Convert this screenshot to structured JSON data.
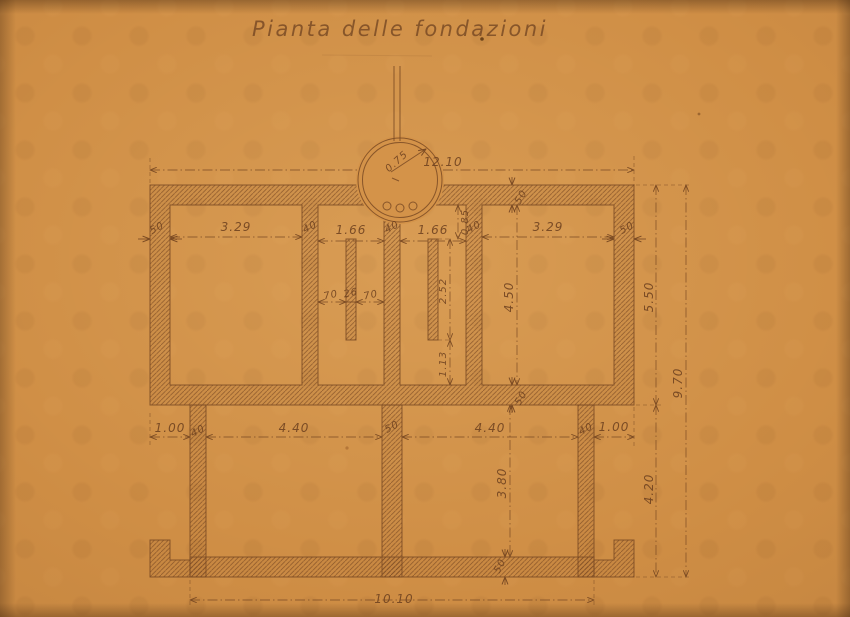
{
  "title": "Pianta delle fondazioni",
  "colors": {
    "paper": "#cf8e45",
    "ink": "#7a4a23"
  },
  "well": {
    "diameter_label": "0.75"
  },
  "labels": {
    "dim_top_width": "12.10",
    "dim_room_tl_width": "3.29",
    "dim_room_tr_width": "3.29",
    "dim_corridor_left_width": "1.66",
    "dim_corridor_right_width": "1.66",
    "dim_wall_left": "50",
    "dim_wall_tl_inner": "40",
    "dim_wall_center": "40",
    "dim_wall_tr_inner": "40",
    "dim_wall_right": "50",
    "dim_top_wall_thickness": "50",
    "dim_offset_pilaster_top": "0.85",
    "dim_pilaster_left_a": "70",
    "dim_pilaster_width": "26",
    "dim_pilaster_left_b": "70",
    "dim_pilaster_length": "2.52",
    "dim_pilaster_bottom": "1.13",
    "dim_room_tr_height": "4.50",
    "dim_mid_wall_thickness": "50",
    "dim_ext_left": "1.00",
    "dim_wall_bl": "40",
    "dim_room_bl_width": "4.40",
    "dim_wall_bm": "50",
    "dim_room_br_width": "4.40",
    "dim_wall_br": "40",
    "dim_ext_right": "1.00",
    "dim_room_br_height": "3.80",
    "dim_bottom_wall_thickness": "50",
    "dim_right_upper": "5.50",
    "dim_right_lower": "4.20",
    "dim_right_total": "9.70",
    "dim_bottom_width": "10.10"
  }
}
